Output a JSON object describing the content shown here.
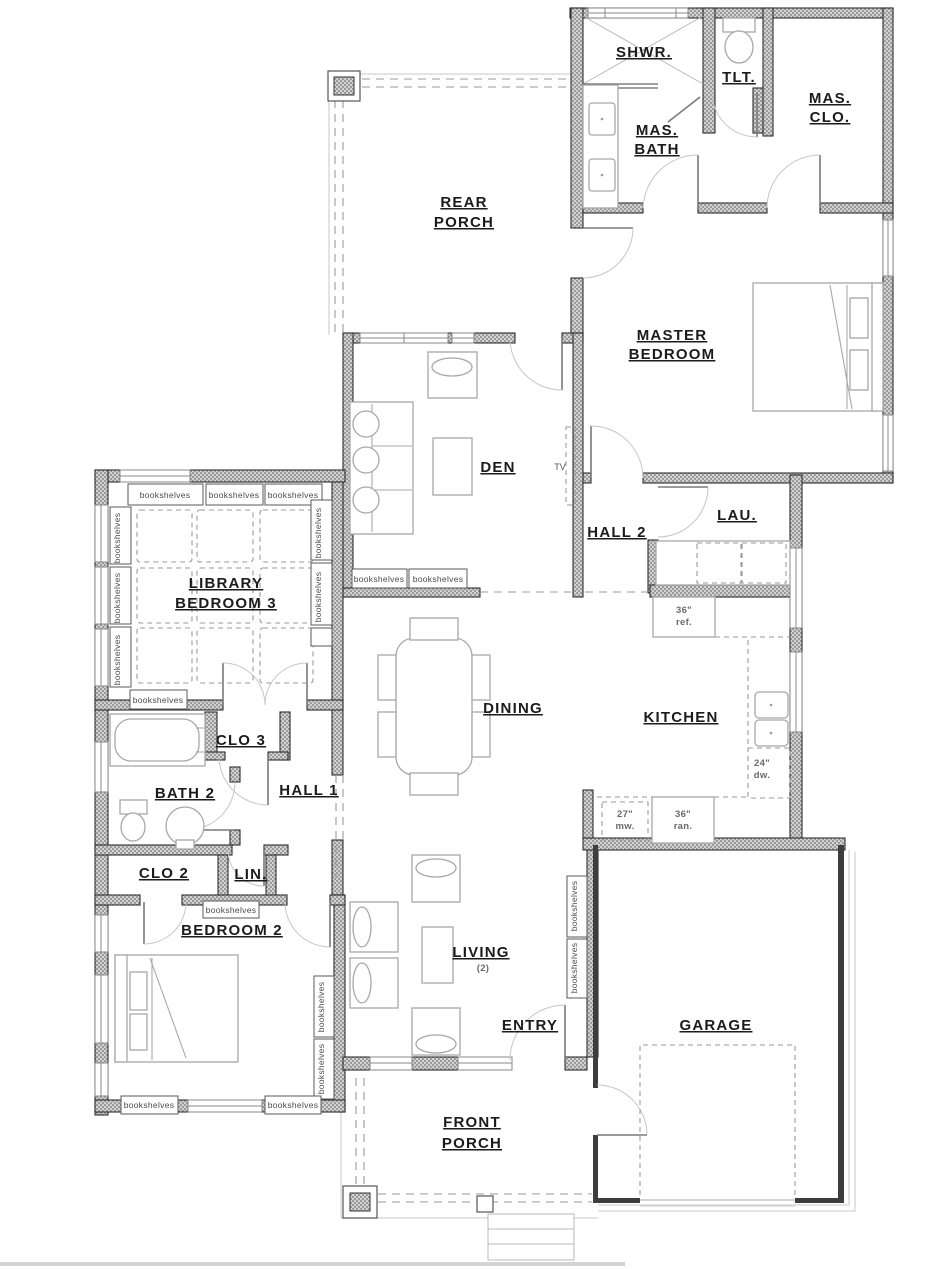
{
  "labels": {
    "bookshelves": "bookshelves",
    "tv": "TV"
  },
  "rooms": {
    "shwr": "SHWR.",
    "tlt": "TLT.",
    "mas_clo": [
      "MAS.",
      "CLO."
    ],
    "mas_bath": [
      "MAS.",
      "BATH"
    ],
    "rear_porch": [
      "REAR",
      "PORCH"
    ],
    "master_bedroom": [
      "MASTER",
      "BEDROOM"
    ],
    "den": "DEN",
    "hall_2": "HALL 2",
    "lau": "LAU.",
    "library": [
      "LIBRARY",
      "BEDROOM 3"
    ],
    "dining": "DINING",
    "kitchen": "KITCHEN",
    "clo_3": "CLO 3",
    "bath_2": "BATH 2",
    "hall_1": "HALL 1",
    "clo_2": "CLO 2",
    "lin": "LIN.",
    "bedroom_2": "BEDROOM 2",
    "living": "LIVING",
    "living_count": "(2)",
    "entry": "ENTRY",
    "garage": "GARAGE",
    "front_porch": [
      "FRONT",
      "PORCH"
    ]
  },
  "appliances": {
    "ref": [
      "36\"",
      "ref."
    ],
    "dw": [
      "24\"",
      "dw."
    ],
    "mw": [
      "27\"",
      "mw."
    ],
    "ran": [
      "36\"",
      "ran."
    ]
  },
  "colors": {
    "paper": "#ffffff",
    "wall_outline": "#2e2e2e",
    "wall_fill": "#c9c9c9",
    "text": "#1b1b1b"
  }
}
